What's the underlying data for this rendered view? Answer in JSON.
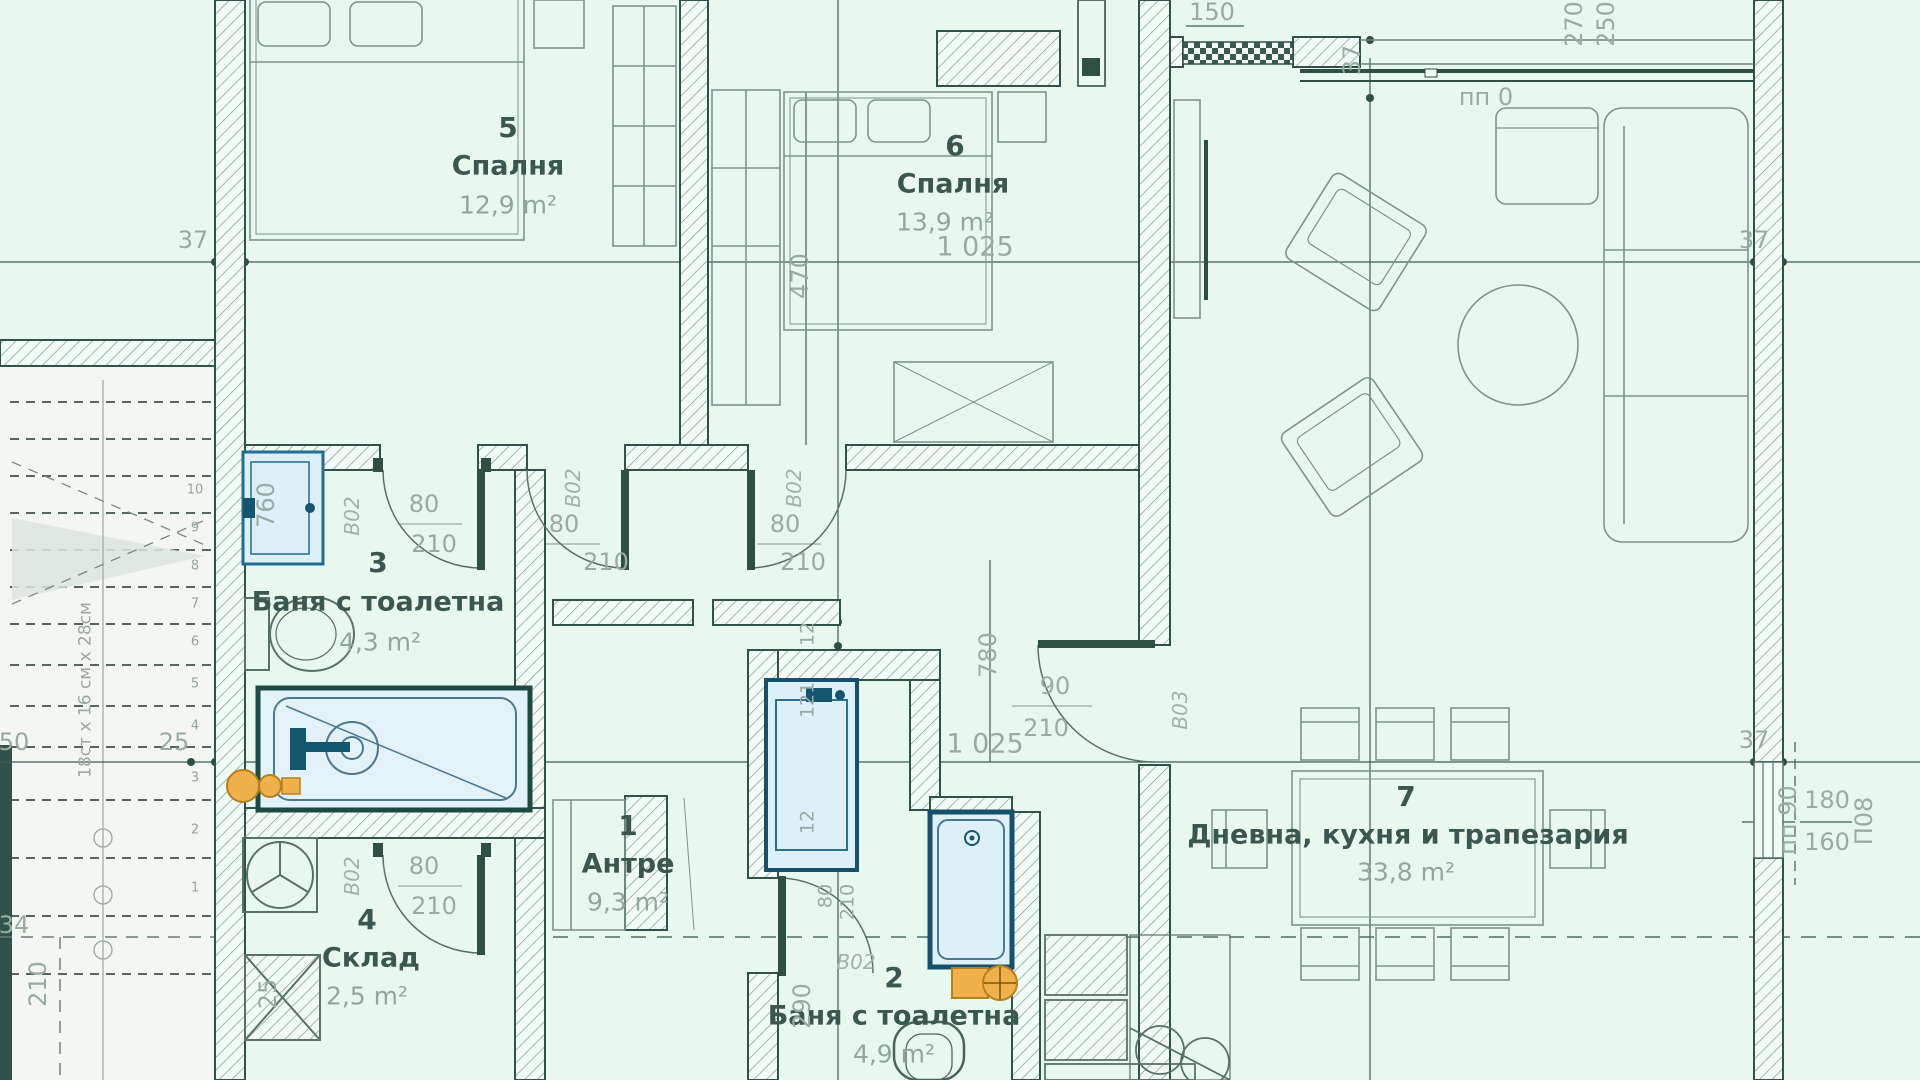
{
  "palette": {
    "background": "#e9f8ef",
    "wall_line": "#31524a",
    "dim_text": "#9aaba3",
    "room_text": "#3a5750",
    "fixture_blue": "#1f6e91",
    "fixture_blue_dark": "#14566f",
    "accent_orange": "#eda43e"
  },
  "rooms": [
    {
      "number": "5",
      "name": "Спалня",
      "area": "12,9 m²"
    },
    {
      "number": "6",
      "name": "Спалня",
      "area": "13,9 m²"
    },
    {
      "number": "3",
      "name": "Баня с тоалетна",
      "area": "4,3 m²"
    },
    {
      "number": "1",
      "name": "Антре",
      "area": "9,3 m²"
    },
    {
      "number": "4",
      "name": "Склад",
      "area": "2,5 m²"
    },
    {
      "number": "2",
      "name": "Баня с тоалетна",
      "area": "4,9 m²"
    },
    {
      "number": "7",
      "name": "Дневна, кухня и трапезария",
      "area": "33,8 m²"
    }
  ],
  "dims": {
    "d37": "37",
    "d470": "470",
    "d1025": "1 025",
    "d12": "12",
    "d121": "121",
    "d780": "780",
    "d80": "80",
    "d90": "90",
    "d210": "210",
    "d760": "760",
    "d290": "290",
    "d25": "25",
    "d50": "50",
    "d34": "34",
    "d150": "150",
    "d270": "270",
    "d250": "250",
    "d180": "180",
    "d160": "160"
  },
  "doors": {
    "b02": "B02",
    "b03": "B03"
  },
  "marks": {
    "pp0": "пп 0",
    "pp90": "пп 90",
    "p08": "П08"
  },
  "stairs": {
    "note": "18ст x 16 см x 28см",
    "steps": [
      "10",
      "9",
      "8",
      "7",
      "6",
      "5",
      "4",
      "3",
      "2",
      "1"
    ]
  }
}
